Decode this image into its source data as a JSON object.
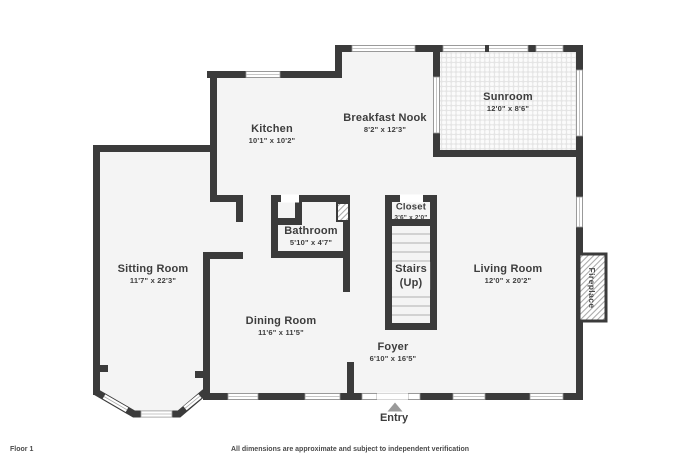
{
  "rooms": {
    "kitchen": {
      "name": "Kitchen",
      "dims": "10'1\" x 10'2\""
    },
    "breakfast_nook": {
      "name": "Breakfast Nook",
      "dims": "8'2\" x 12'3\""
    },
    "sunroom": {
      "name": "Sunroom",
      "dims": "12'0\" x 8'6\""
    },
    "sitting_room": {
      "name": "Sitting Room",
      "dims": "11'7\" x 22'3\""
    },
    "bathroom": {
      "name": "Bathroom",
      "dims": "5'10\" x 4'7\""
    },
    "closet": {
      "name": "Closet",
      "dims": "3'6\" x 2'0\""
    },
    "stairs": {
      "name": "Stairs",
      "dims": "(Up)"
    },
    "living_room": {
      "name": "Living Room",
      "dims": "12'0\" x 20'2\""
    },
    "dining_room": {
      "name": "Dining Room",
      "dims": "11'6\" x 11'5\""
    },
    "foyer": {
      "name": "Foyer",
      "dims": "6'10\" x 16'5\""
    }
  },
  "annotations": {
    "entry": "Entry",
    "fireplace": "Fireplace"
  },
  "footer": {
    "floor_label": "Floor 1",
    "disclaimer": "All dimensions are approximate and subject to independent verification"
  },
  "colors": {
    "wall": "#3b3b3b",
    "floor": "#f4f4f4",
    "window_frame": "#999999",
    "entry_arrow": "#9a9a9a",
    "text": "#3d3d3d",
    "background": "#ffffff"
  }
}
